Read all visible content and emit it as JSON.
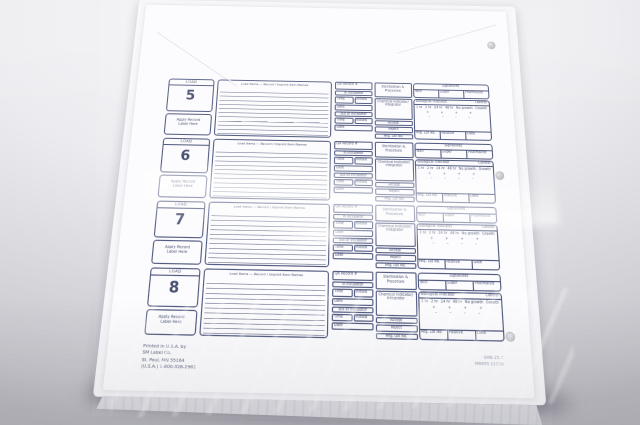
{
  "photo": {
    "backdrop_top_color": "#f6f5f7",
    "backdrop_bottom_color": "#bcbbc2",
    "paper_color": "#fcfcfe",
    "ink_color": "#3e4668"
  },
  "form": {
    "load_caption": "LOAD",
    "apply_label": "Apply Record Label Here",
    "lined_header": "Load Items — Record / Imprint Item Names",
    "loads": [
      {
        "number": "5"
      },
      {
        "number": "6"
      },
      {
        "number": "7"
      },
      {
        "number": "8"
      }
    ],
    "grid": {
      "qa_record": "QA Record #",
      "in_incubator": "in incubator",
      "out_incubator": "out of incubator",
      "time": "Time",
      "initials": "Initials",
      "date": "Date",
      "sterilizer": "Sterilization & Procedure",
      "signatures": "Signatures",
      "sig_cells": [
        "Tech",
        "Super",
        "Pharmacist"
      ],
      "chemical": "Chemical indicator/ integrator",
      "accept": "Accept",
      "reject": "Reject",
      "mfg_lot": "Mfg. Lot No.",
      "biological": "Biological indicator",
      "control": "Control",
      "scale": [
        "1 hr",
        "2 hr",
        "24 hr",
        "48 hr",
        "No growth",
        "Growth"
      ],
      "plus_row": "+ + + +",
      "minus_row": "– – – –",
      "positive": "Positive"
    },
    "footer_left_lines": [
      "Printed in U.S.A. by",
      "SM Label Co.",
      "St. Paul, MN 55164",
      "(U.S.A.) 1-800-328-2962"
    ],
    "footer_right_lines": [
      "SMB 25-7",
      "MR695 1125A"
    ]
  }
}
